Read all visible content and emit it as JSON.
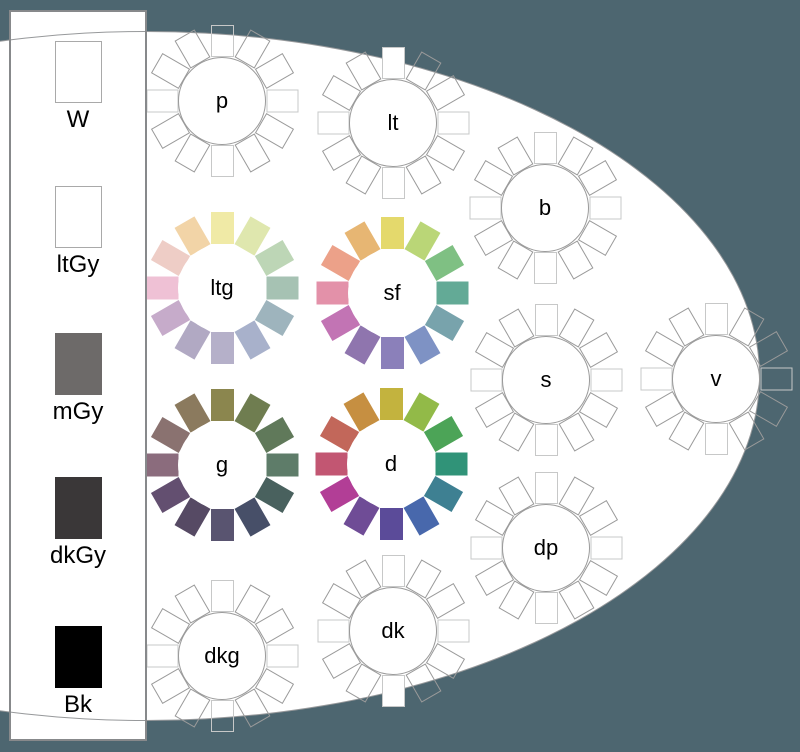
{
  "background_color": "#4d6670",
  "ellipse": {
    "fill": "#ffffff",
    "border_color": "#97999b"
  },
  "outline_colors": {
    "cardinal": "#c7c8c8",
    "diagonal": "#9a9a9a",
    "hub": "#9a9a9a"
  },
  "sidebar": {
    "swatches": [
      {
        "id": "W",
        "label": "W",
        "fill": "#ffffff",
        "border": "#a9a9a9"
      },
      {
        "id": "ltGy",
        "label": "ltGy",
        "fill": "#ffffff",
        "border": "#a9a9a9"
      },
      {
        "id": "mGy",
        "label": "mGy",
        "fill": "#6d6a69",
        "border": "none"
      },
      {
        "id": "dkGy",
        "label": "dkGy",
        "fill": "#3a3738",
        "border": "none"
      },
      {
        "id": "Bk",
        "label": "Bk",
        "fill": "#000000",
        "border": "none"
      }
    ]
  },
  "wheels": [
    {
      "id": "p",
      "label": "p",
      "cx": 222,
      "cy": 101,
      "type": "outline",
      "filled": []
    },
    {
      "id": "lt",
      "label": "lt",
      "cx": 393,
      "cy": 123,
      "type": "outline",
      "filled": [
        0
      ]
    },
    {
      "id": "b",
      "label": "b",
      "cx": 545,
      "cy": 208,
      "type": "outline",
      "filled": []
    },
    {
      "id": "ltg",
      "label": "ltg",
      "cx": 222,
      "cy": 288,
      "type": "color",
      "colors": [
        "#f0eaa6",
        "#dfe7ae",
        "#bdd6b6",
        "#a6c2b3",
        "#9eb4bd",
        "#a8b1cb",
        "#b5b0c9",
        "#b1a9c3",
        "#c6abca",
        "#efc1d5",
        "#eecdc6",
        "#f2d4a7"
      ]
    },
    {
      "id": "sf",
      "label": "sf",
      "cx": 392,
      "cy": 293,
      "type": "color",
      "colors": [
        "#e4d96c",
        "#bad677",
        "#7fc083",
        "#63aa96",
        "#78a3ac",
        "#7e92c4",
        "#8b80ba",
        "#8f75ae",
        "#c274b4",
        "#e391a9",
        "#eca189",
        "#e7b673"
      ]
    },
    {
      "id": "s",
      "label": "s",
      "cx": 546,
      "cy": 380,
      "type": "outline",
      "filled": []
    },
    {
      "id": "v",
      "label": "v",
      "cx": 716,
      "cy": 379,
      "type": "outline",
      "filled": []
    },
    {
      "id": "g",
      "label": "g",
      "cx": 222,
      "cy": 465,
      "type": "color",
      "colors": [
        "#8b864e",
        "#6f7d50",
        "#60795a",
        "#5e7c69",
        "#49615e",
        "#474f68",
        "#595470",
        "#564a64",
        "#634f70",
        "#8b6c7d",
        "#8a7270",
        "#8b7a5e"
      ]
    },
    {
      "id": "d",
      "label": "d",
      "cx": 391,
      "cy": 464,
      "type": "color",
      "colors": [
        "#c3b33e",
        "#92ba48",
        "#4ca457",
        "#309378",
        "#3e8092",
        "#4868ac",
        "#5b4b99",
        "#6f4c96",
        "#b23e96",
        "#c25672",
        "#c2675a",
        "#c68f41"
      ]
    },
    {
      "id": "dp",
      "label": "dp",
      "cx": 546,
      "cy": 548,
      "type": "outline",
      "filled": []
    },
    {
      "id": "dk",
      "label": "dk",
      "cx": 393,
      "cy": 631,
      "type": "outline",
      "filled": [
        6
      ]
    },
    {
      "id": "dkg",
      "label": "dkg",
      "cx": 222,
      "cy": 656,
      "type": "outline",
      "filled": []
    }
  ]
}
